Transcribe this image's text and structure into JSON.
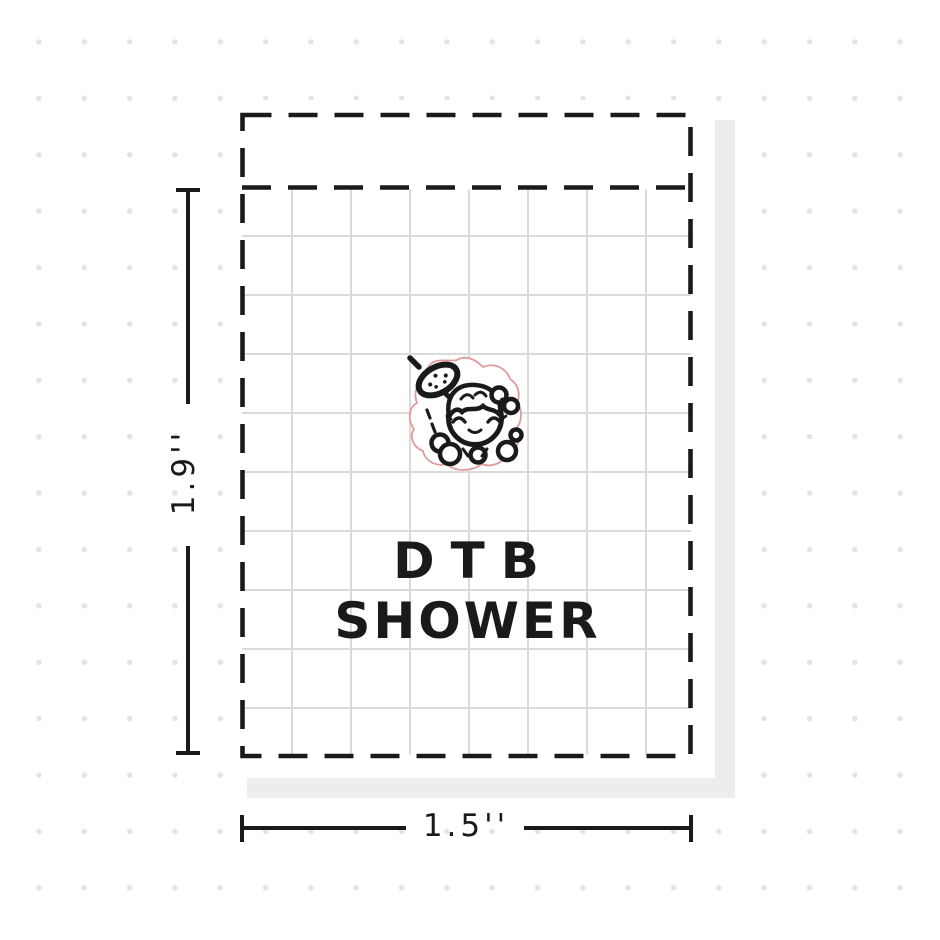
{
  "product": {
    "title_line1": "DTB",
    "title_line2": "SHOWER"
  },
  "dimensions": {
    "height_label": "1.9''",
    "width_label": "1.5''"
  },
  "sticker": {
    "icon": "shower-girl-sticker",
    "description_elements": [
      "shower-head-icon",
      "water-drops",
      "girl-face",
      "hair",
      "bow-icon",
      "soap-bubbles",
      "diecut-outline"
    ]
  },
  "colors": {
    "ink": "#1a1a1a",
    "grid_line": "#dadada",
    "background_dot": "#e3e3e3",
    "sheet_shadow": "#ededed",
    "diecut_outline": "#e39a9a",
    "sheet_background": "#ffffff"
  }
}
